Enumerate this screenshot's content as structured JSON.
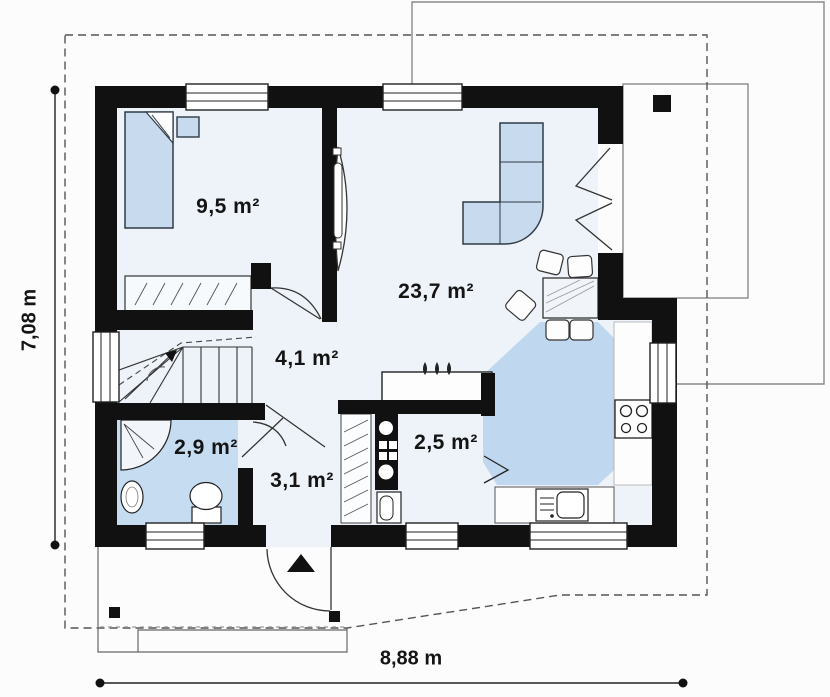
{
  "plan": {
    "title": "house-first-floor-plan",
    "rooms": [
      {
        "name": "bedroom",
        "area": "9,5 m²"
      },
      {
        "name": "living-room",
        "area": "23,7 m²"
      },
      {
        "name": "hall",
        "area": "4,1 m²"
      },
      {
        "name": "bathroom",
        "area": "2,9 m²"
      },
      {
        "name": "corridor",
        "area": "3,1 m²"
      },
      {
        "name": "utility-room",
        "area": "2,5 m²"
      }
    ],
    "dimensions": {
      "total_width": "8,88 m",
      "total_height": "7,08 m"
    },
    "colors": {
      "wall": "#111111",
      "interior_floor": "#eef3f9",
      "wet_room_floor": "#c6dcf1",
      "furniture_fill": "#c8dbee",
      "outline_gray": "#888888",
      "dashed_eaves": "#555555",
      "background": "#fcfcfc"
    }
  }
}
